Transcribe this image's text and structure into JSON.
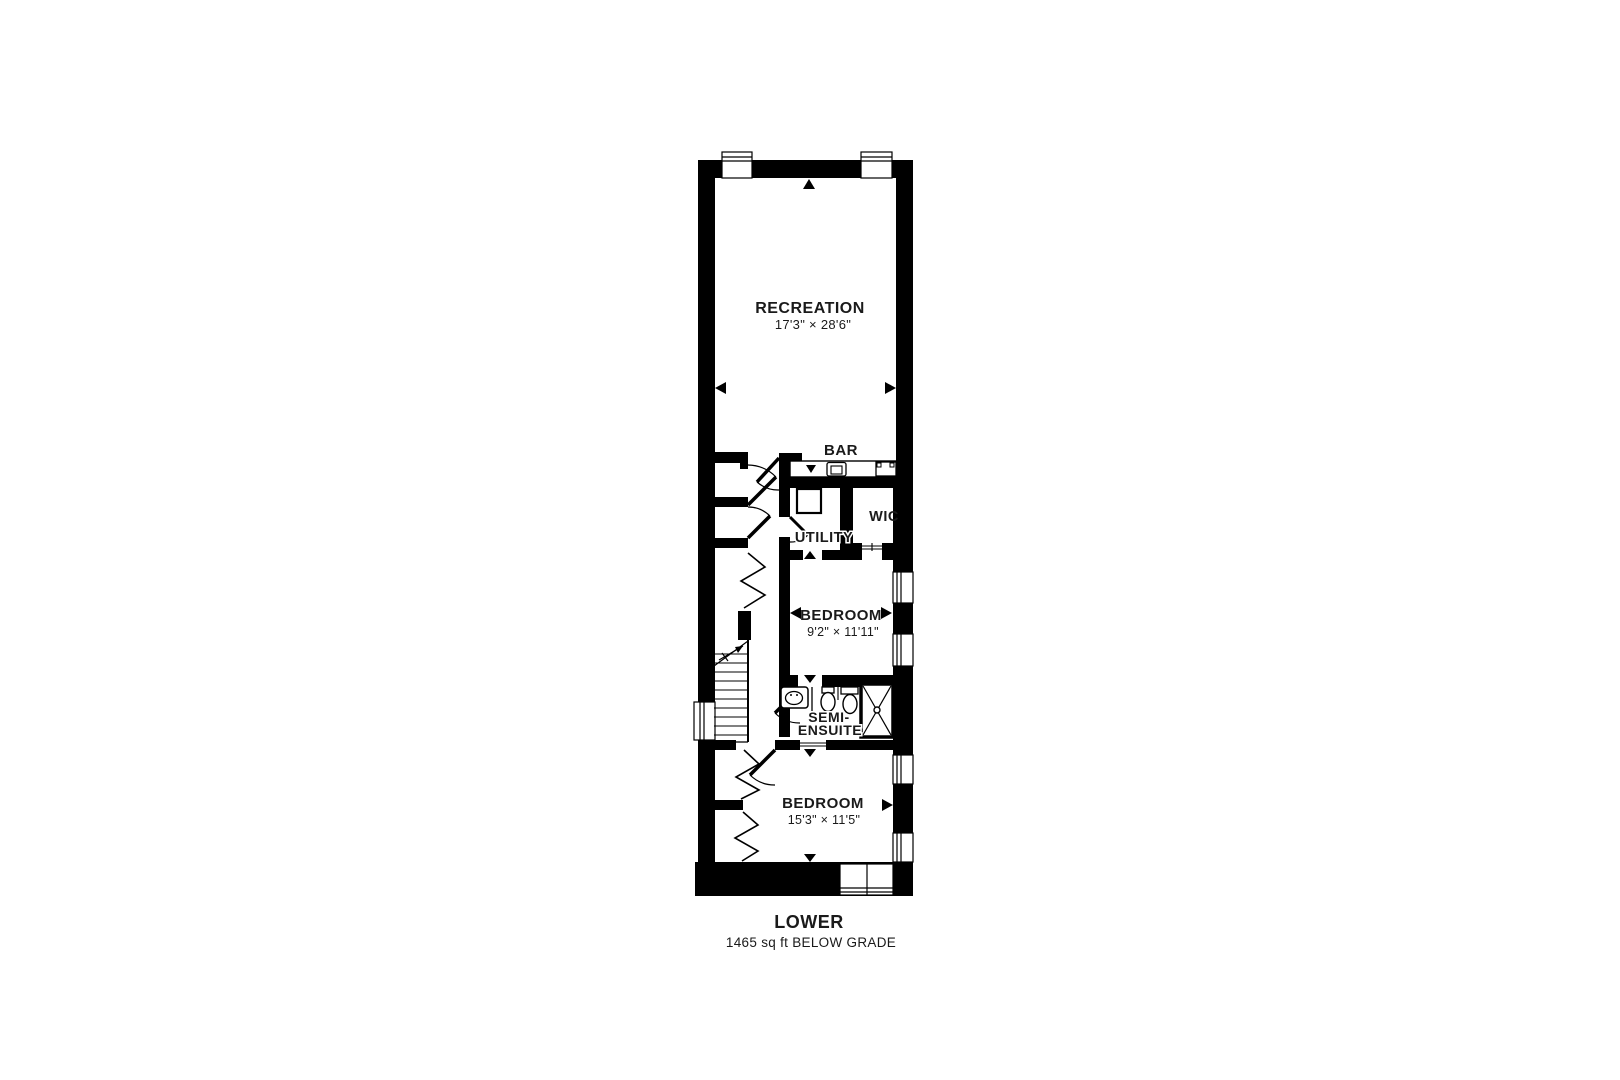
{
  "floor_plan": {
    "footer": {
      "level_name": "LOWER",
      "area_note": "1465 sq ft BELOW GRADE"
    },
    "rooms": {
      "recreation": {
        "label": "RECREATION",
        "dims": "17'3\" × 28'6\""
      },
      "bar": {
        "label": "BAR"
      },
      "wic": {
        "label": "WIC"
      },
      "utility": {
        "label": "UTILITY"
      },
      "bedroom_upper": {
        "label": "BEDROOM",
        "dims": "9'2\" × 11'11\""
      },
      "semi_ensuite": {
        "line1": "SEMI-",
        "line2": "ENSUITE"
      },
      "bedroom_lower": {
        "label": "BEDROOM",
        "dims": "15'3\" × 11'5\""
      }
    },
    "colors": {
      "wall": "#000000",
      "floor": "#ffffff",
      "page_background": "#ffffff"
    }
  }
}
